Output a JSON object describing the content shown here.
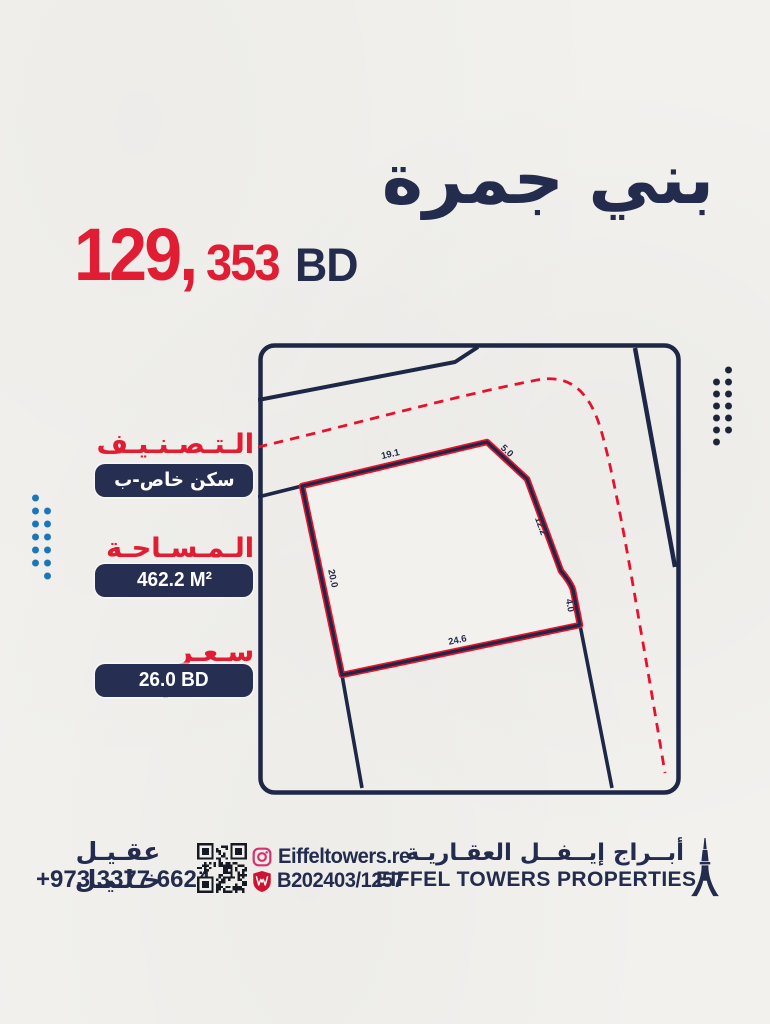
{
  "title_ar": "بني جمرة",
  "price": {
    "amount_major": "129,",
    "amount_minor": "353",
    "currency": "BD"
  },
  "specs": {
    "classification": {
      "label": "الـتـصـنـيـف",
      "value": "سكن خاص-ب"
    },
    "area": {
      "label": "الـمـسـاحـة",
      "value": "462.2 M²"
    },
    "price_per_foot": {
      "label": "سـعـر الـقـدم",
      "value": "26.0 BD"
    }
  },
  "map": {
    "dim_top": "19.1",
    "dim_top_right": "5.0",
    "dim_right": "12.2",
    "dim_bottom_right": "4.0",
    "dim_bottom": "24.6",
    "dim_left": "20.0"
  },
  "footer": {
    "agent_name": "عقـيـل خـلـيـل",
    "agent_phone": "+973 3377 6624",
    "instagram_handle": "Eiffeltowers.re",
    "license_number": "B202403/1257",
    "company_name_ar": "أبــراج إيــفــل العقـاريـة",
    "company_name_en": "EIFFEL TOWERS PROPERTIES"
  },
  "colors": {
    "navy": "#242c4e",
    "red": "#e11d33",
    "dots_blue": "#1b76b9",
    "instagram_pink": "#d6306e",
    "shield_red": "#ce1230"
  }
}
